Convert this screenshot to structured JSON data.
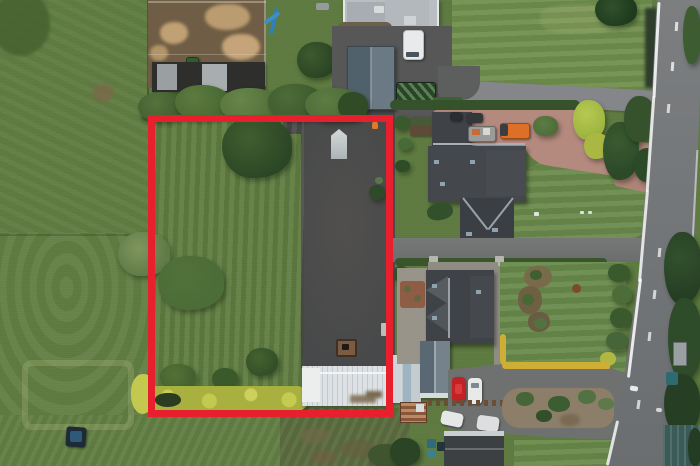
{
  "scene": {
    "type": "aerial-drone-photo",
    "description": "Aerial drone photograph of a rural property. A red rectangle outlines a plot containing a lawn with trees, a dark tarmac yard with a parked trailer, a yellow hedge and a white greenhouse. Around it: grass fields with mowing stripes, a dirt paddock with sheds, a white farmhouse, two neighbouring houses with dark roofs, a pink block-paved driveway with an orange truck, parked cars, and a country road running down the right side.",
    "boundary": {
      "shape": "rectangle",
      "purpose": "plot outline"
    }
  },
  "labels": {
    "photo": "Aerial photograph of land plot outlined in red",
    "red_plot_boundary": "Red plot boundary",
    "plot_lawn": "Plot lawn",
    "plot_yard": "Plot tarmac yard",
    "plot_trailer": "Parked trailer",
    "greenhouse": "Greenhouse",
    "yellow_hedge": "Yellow hedge",
    "left_field": "Grass field with mowing stripes",
    "paddock": "Dirt paddock",
    "paddock_shed": "Paddock shed",
    "farmhouse": "White farmhouse",
    "garden_shed": "Grey garden shed",
    "white_van": "White van",
    "flatbed_trailer": "Green flatbed trailer",
    "north_house": "Neighbouring house (north)",
    "south_house": "Neighbouring house (south)",
    "pink_driveway": "Pink block-paved driveway",
    "orange_truck": "Orange truck",
    "red_car": "Red car",
    "white_car": "White car",
    "road": "Country road",
    "road_sign": "Roadside sign",
    "garage": "Detached garage",
    "bins": "Wheelie bins",
    "pool": "Covered garden pool",
    "tree_row": "Row of trees",
    "gravel_garden": "Gravel garden bed",
    "playground_slide": "Blue garden slide",
    "dark_tank": "Dark covered object in field"
  },
  "colors": {
    "boundary_red": "#e81f2d",
    "grass_green": "#5e7b41",
    "yard_tarmac": "#48494a",
    "road_grey": "#75787a",
    "pink_paving": "#b4897e",
    "roof_dark": "#3f4347",
    "greenhouse_white": "#dde1e3",
    "hedge_yellow": "#b8c044",
    "truck_orange": "#dd6f26",
    "car_red": "#c22126",
    "paddock_dirt": "#6f5d45"
  }
}
